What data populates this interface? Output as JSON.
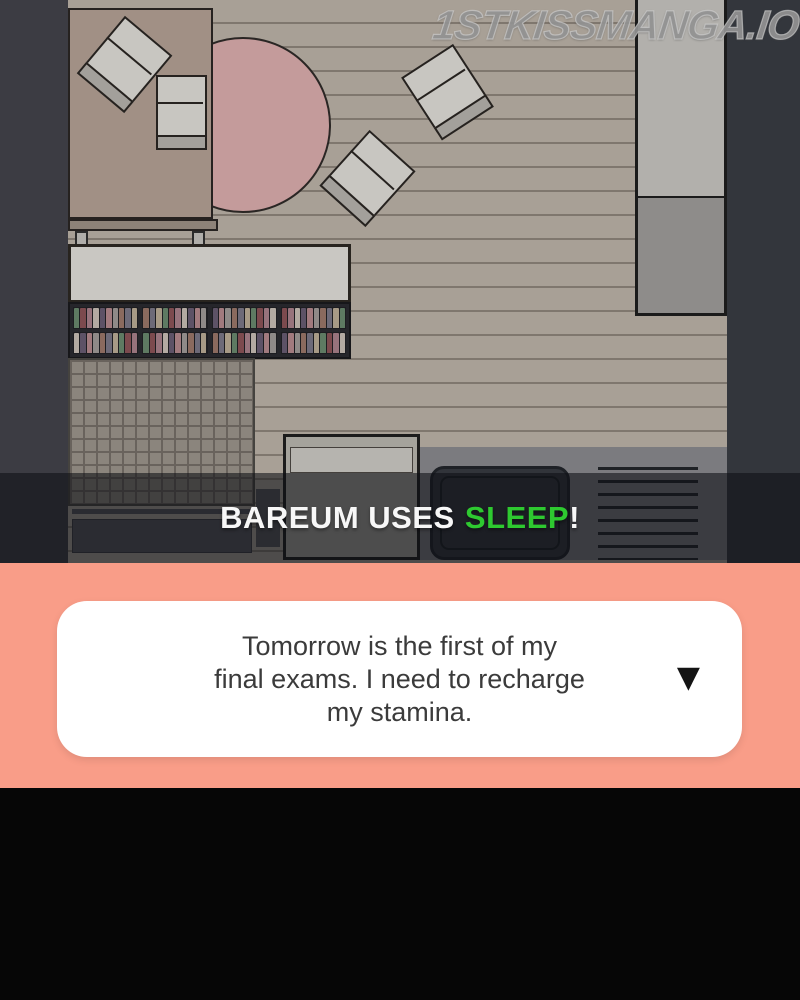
{
  "watermark": {
    "text": "1STKISSMANGA.IO"
  },
  "battle_caption": {
    "prefix": "BAREUM USES",
    "highlight": "SLEEP",
    "suffix": "!",
    "text_color": "#f7f7f7",
    "highlight_color": "#2ec930"
  },
  "dialog": {
    "lines": [
      "Tomorrow is the first of my",
      "final exams. I need to recharge",
      "my stamina."
    ],
    "dropdown_icon": "▼",
    "panel_background": "#f99d88",
    "bubble_background": "#ffffff",
    "text_color": "#3b3b3b"
  },
  "room": {
    "bookshelf": {
      "rows": 2,
      "groups_per_row": 4,
      "spines_per_group": 10,
      "spine_palette": [
        "#5e7a62",
        "#7c4a4e",
        "#97737c",
        "#b3aaa2",
        "#5d5266",
        "#a17a7e",
        "#8f8a88",
        "#8a6a5e",
        "#6d6a78",
        "#a79a86"
      ]
    },
    "colors": {
      "floor": "#a8a096",
      "plank_line": "#7f776e",
      "left_wall": "#3c3c43",
      "right_wall": "#33363c",
      "round_rug": "#c49b9b",
      "table": "#a19085",
      "chair": "#c8c6c1",
      "bed_head": "#b2b0ac",
      "bed_foot": "#8e8c8a",
      "desk": "#c9c7c2",
      "overlay": "rgba(14,16,20,0.58)"
    }
  },
  "footer": {
    "background": "#060606"
  }
}
